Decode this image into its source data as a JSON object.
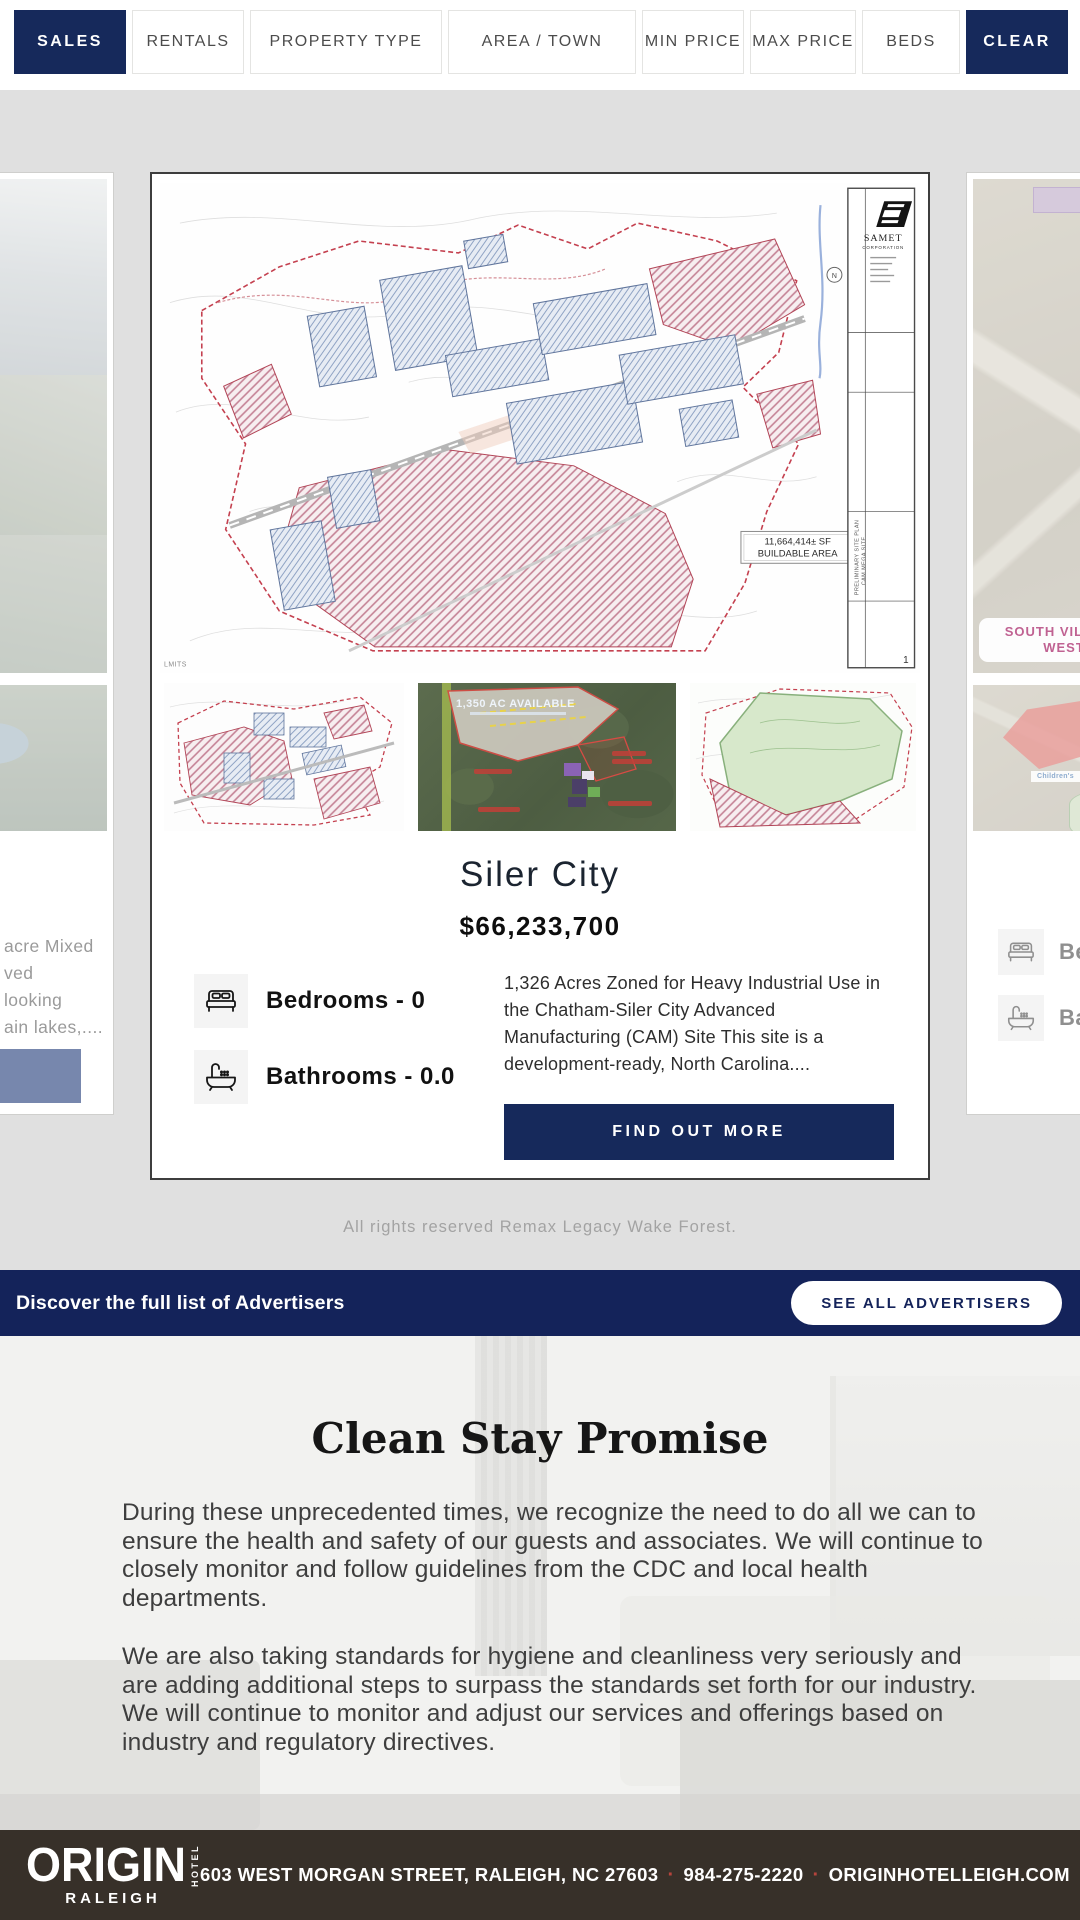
{
  "colors": {
    "navy": "#16295b",
    "banner_navy": "#14235a",
    "footer_bg": "#373029",
    "page_bg": "#e0e0e0",
    "slate_button": "#7787ad",
    "accent_red": "#b5443c",
    "chip_pink": "#c06292"
  },
  "filter_bar": {
    "buttons": [
      {
        "label": "SALES",
        "active": true
      },
      {
        "label": "RENTALS",
        "active": false
      },
      {
        "label": "PROPERTY TYPE",
        "active": false
      },
      {
        "label": "AREA / TOWN",
        "active": false
      },
      {
        "label": "MIN PRICE",
        "active": false
      },
      {
        "label": "MAX PRICE",
        "active": false
      },
      {
        "label": "BEDS",
        "active": false
      },
      {
        "label": "CLEAR",
        "active": true
      }
    ]
  },
  "carousel": {
    "copyright": "All rights reserved Remax Legacy Wake Forest.",
    "left_card": {
      "fragments": [
        "acre Mixed",
        "ved",
        "looking",
        "ain lakes,...."
      ]
    },
    "main_card": {
      "title": "Siler City",
      "price": "$66,233,700",
      "bedrooms": "Bedrooms - 0",
      "bathrooms": "Bathrooms - 0.0",
      "description": "1,326 Acres Zoned for Heavy Industrial Use in the Chatham-Siler City Advanced Manufacturing (CAM) Site This site is a development-ready, North Carolina....",
      "cta": "FIND OUT MORE",
      "thumb2_label": "1,350 AC AVAILABLE",
      "siteplan": {
        "firm_name": "SAMET",
        "firm_subtitle": "CORPORATION",
        "buildable_line1": "11,664,414± SF",
        "buildable_line2": "BUILDABLE AREA",
        "compass": "N",
        "sheet_number": "1",
        "rotated_label1": "PRELIMINARY SITE PLAN",
        "rotated_label2": "CAM MEGA SITE",
        "edge_fragment": "LMITS"
      }
    },
    "right_card": {
      "map_label": "SOUTH VILLAGE WEST",
      "map_sublabel": "Children's",
      "bedrooms_fragment": "Be",
      "bathrooms_fragment": "Ba"
    }
  },
  "advertisers": {
    "text": "Discover the full list of Advertisers",
    "button": "SEE ALL ADVERTISERS"
  },
  "clean_stay": {
    "title": "Clean Stay Promise",
    "paragraphs": [
      "During these unprecedented times, we recognize the need to do all we can to ensure the health and safety of our guests and associates. We will continue to closely monitor and follow guidelines from the CDC and local health departments.",
      "We are also taking standards for hygiene and cleanliness very seriously and are adding additional steps to surpass the standards set forth for our industry. We will continue to monitor and adjust our services and offerings based on industry and regulatory directives."
    ]
  },
  "footer": {
    "logo_primary": "ORIGIN",
    "logo_vertical": "HOTEL",
    "logo_city": "RALEIGH",
    "address": "603 WEST MORGAN STREET, RALEIGH, NC 27603",
    "phone": "984-275-2220",
    "website": "ORIGINHOTELLEIGH.COM",
    "separator": "·"
  }
}
